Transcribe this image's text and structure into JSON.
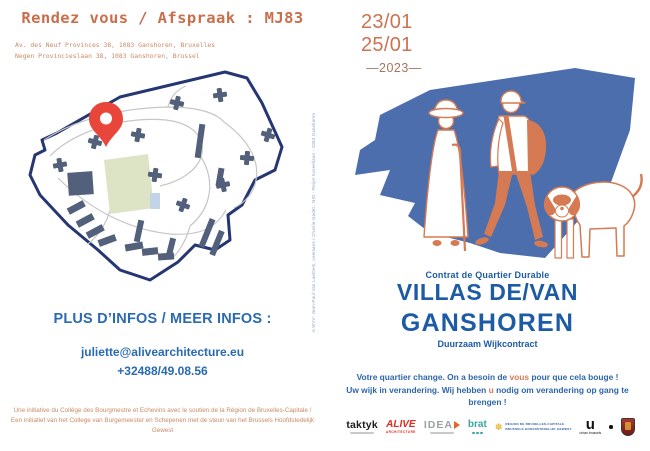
{
  "left_panel": {
    "title": "Rendez vous / Afspraak : MJ83",
    "address_line1": "Av. des Neuf Provinces 38, 1083 Ganshoren, Bruxelles",
    "address_line2": "Negen Provincieslaan 38, 1083 Ganshoren, Brussel",
    "infos_heading": "PLUS D’INFOS / MEER INFOS :",
    "email": "juliette@alivearchitecture.eu",
    "phone": "+32488/49.08.56",
    "footer_credit": "Une initiative du Collège des Bourgmestre et Echevins avec le soutien de la Région de Bruxelles-Capitale / Een initiatief van het College van Burgemeester en Schepenen met de steun van het Brussels Hoofdstedelijk Gewest"
  },
  "spine": {
    "credit_vertical": "©WVV: Jean-Paul Van Laethem, Leemans / Charlie Godet : NID - Reijer Kareellaan - 1083 Ganshoren"
  },
  "right_panel": {
    "date_line1": "23/01",
    "date_line2": "25/01",
    "year": "—2023—",
    "program_label_fr": "Contrat de Quartier Durable",
    "title_line1": "VILLAS DE/VAN",
    "title_line2": "GANSHOREN",
    "program_label_nl": "Duurzaam Wijkcontract",
    "cta_fr": {
      "pre": "Votre quartier change. On a besoin de ",
      "highlight": "vous",
      "post": " pour que cela bouge !"
    },
    "cta_nl": {
      "pre": "Uw wijk in verandering. Wij hebben ",
      "highlight": "u",
      "post": " nodig om verandering op gang te brengen !"
    },
    "logos": {
      "taktyk": "taktyk",
      "alive": "ALIVE",
      "alive_sub": "ARCHITECTURE",
      "idea": "IDEA",
      "brat": "brat",
      "region_line1": "RÉGION DE BRUXELLES-CAPITALE",
      "region_line2": "BRUSSELS HOOFDSTEDELIJK GEWEST",
      "urban": "u",
      "urban_sub": "urban.brussels",
      "iris_icon": "✽"
    }
  },
  "colors": {
    "accent_orange": "#cc7352",
    "accent_orange_light": "#cd8a65",
    "heading_blue": "#2a6ab3",
    "title_blue": "#1d5ca5",
    "map_border_navy": "#253672",
    "building_slate": "#53607b",
    "park_green": "#dde4c5",
    "pin_red": "#e8453b",
    "illustration_blue": "#4c6ead",
    "illustration_orange": "#d57a52"
  }
}
